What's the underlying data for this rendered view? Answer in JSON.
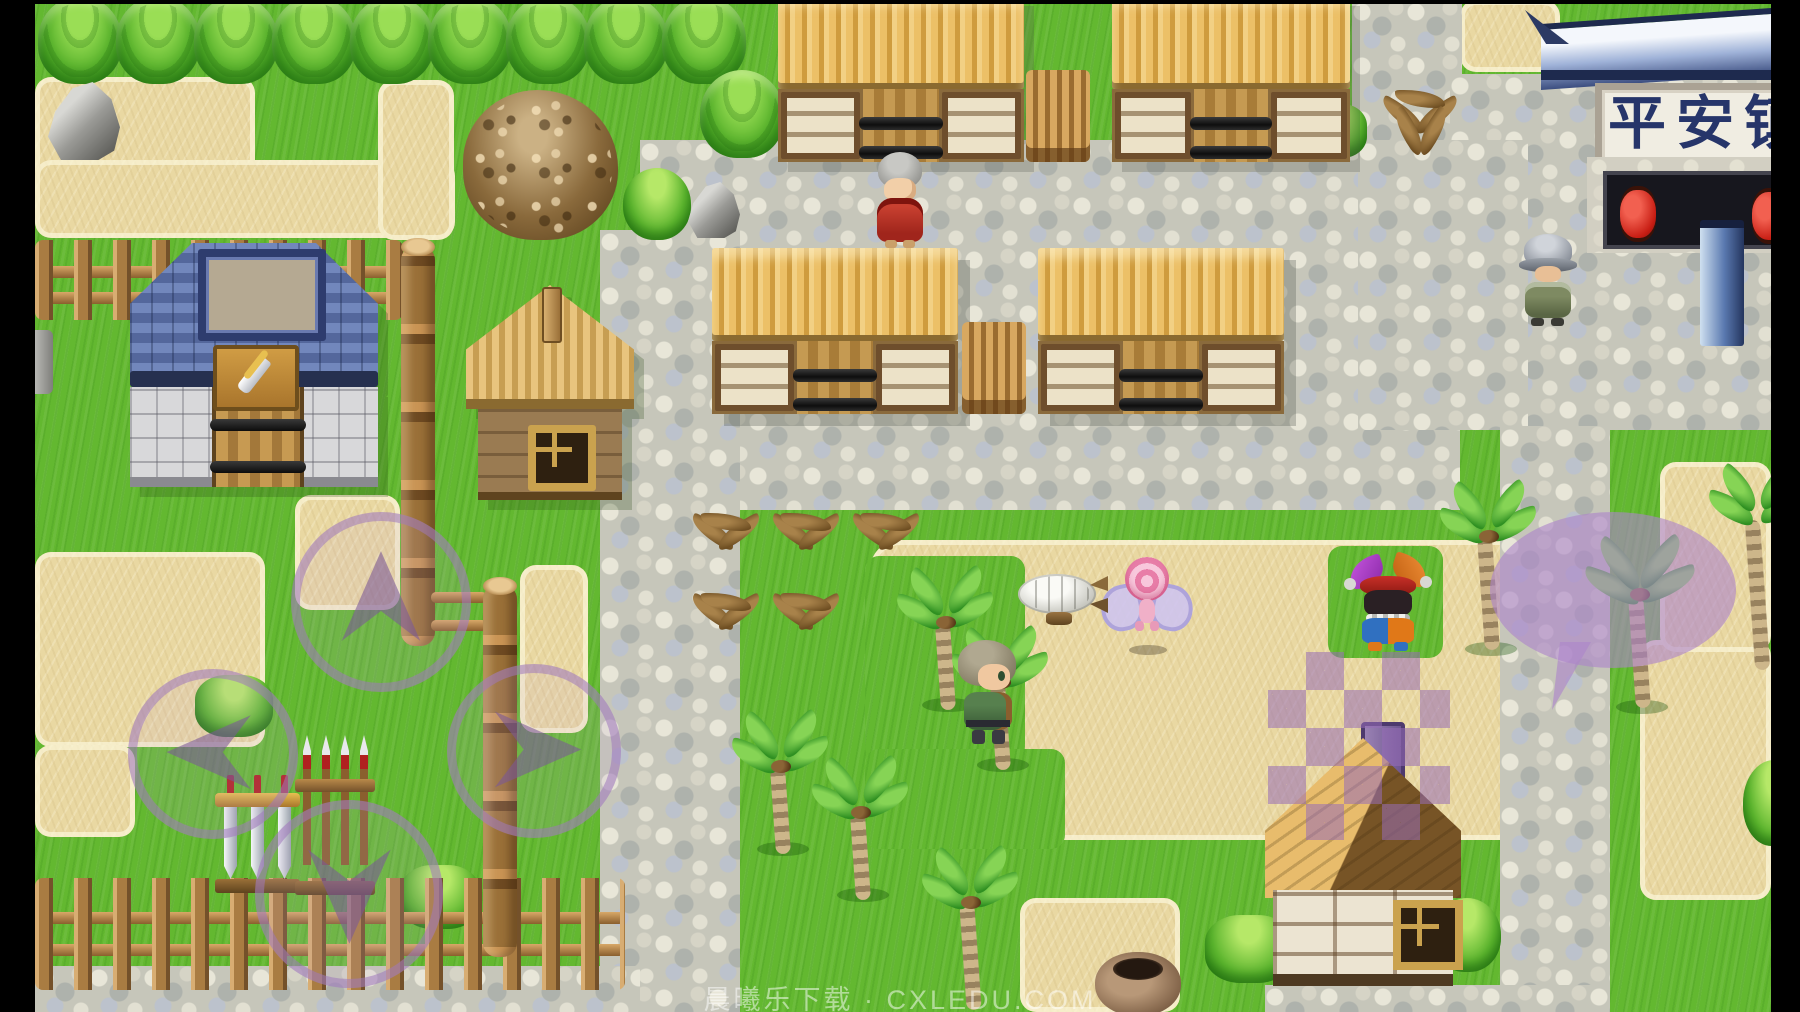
{
  "window": {
    "width": 1800,
    "height": 1012,
    "letterbox_color": "#000000"
  },
  "scene": {
    "type": "rpg-town-map",
    "signboard_text": "平安镇",
    "watermark_text": "晨曦乐下载 · CXLEDU.COM"
  },
  "hud": {
    "dpad": {
      "up": "move-up",
      "down": "move-down",
      "left": "move-left",
      "right": "move-right",
      "color": "#9e78bc"
    },
    "chat_bubble": {
      "name": "speech-bubble-button",
      "color": "#ac84ca"
    },
    "transition_diamonds": {
      "name": "diamond-transition-overlay",
      "color": "#966cb6"
    }
  },
  "buildings": {
    "weapon_shop": {
      "sign_icon": "sword-icon",
      "roof_color": "#5a6ea2",
      "wall_color": "#dcdcdc"
    },
    "wooden_house": {
      "roof_color": "#e0ba74"
    },
    "farm_stalls_count": 4,
    "town_gate": {
      "sign_text": "平安镇",
      "lantern_count": 2,
      "lantern_color": "#c81e14"
    },
    "plank_house": {
      "roof_colors": [
        "#e8bc6c",
        "#775426"
      ]
    }
  },
  "entities": {
    "npcs": [
      {
        "name": "elder-villager",
        "robe_color": "#b23026",
        "hair_color": "#9a9a96"
      },
      {
        "name": "town-guard",
        "armor_color": "#6e7a58",
        "helmet_color": "#9aa0a8"
      },
      {
        "name": "jester",
        "hat_colors": [
          "#b040d0",
          "#e07818"
        ]
      },
      {
        "name": "hero",
        "hair_color": "#8a8068",
        "jacket_color": "#4a6e46"
      },
      {
        "name": "flower-fairy",
        "head_color": "#ee86b4",
        "wing_color": "#cec4ee"
      }
    ],
    "objects": [
      "airship",
      "clay-pot",
      "gravel-mound",
      "boulder",
      "sword-rack",
      "spear-rack",
      "firewood-pile",
      "palm-tree",
      "dried-fern",
      "bush",
      "tree",
      "stone-lantern-fragment"
    ]
  },
  "terrain_colors": {
    "grass": "#63b830",
    "sand": "#e9d8a2",
    "cobblestone": "#c6c6ba"
  }
}
